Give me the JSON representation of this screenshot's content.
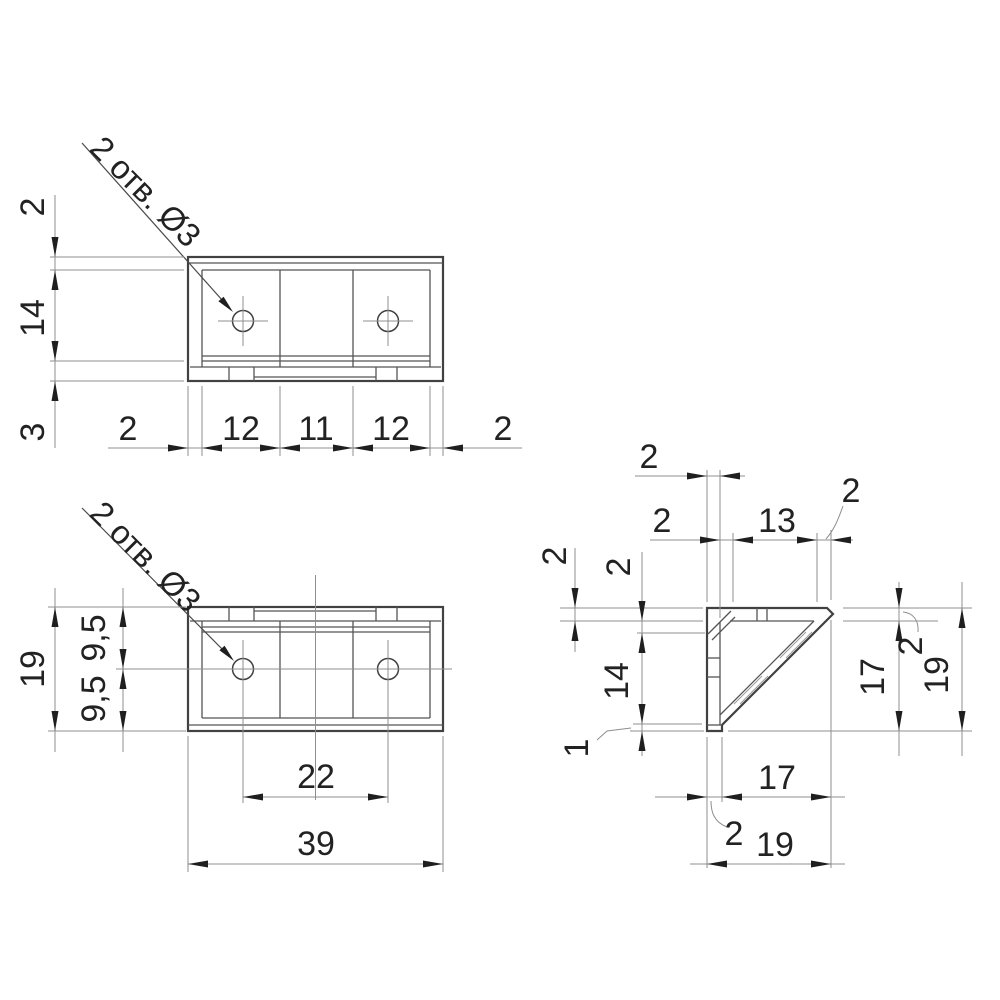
{
  "drawing": {
    "title": "corner-bracket-three-view-drawing",
    "callout_text": "2 отв. Ø3",
    "top_view": {
      "callout": "2 отв. Ø3",
      "left_dims": [
        "2",
        "14",
        "3"
      ],
      "bottom_dims": [
        "2",
        "12",
        "11",
        "12",
        "2"
      ]
    },
    "front_view": {
      "callout": "2 отв. Ø3",
      "left_dims": [
        "19",
        "9,5",
        "9,5"
      ],
      "bottom_dims": [
        "22",
        "39"
      ]
    },
    "side_view": {
      "wall_thickness_dim": "2",
      "top_dims": [
        "2",
        "13",
        "2"
      ],
      "left_dims": [
        "2",
        "2",
        "14",
        "1"
      ],
      "right_dims": [
        "17",
        "2",
        "19"
      ],
      "bottom_dims": [
        "17",
        "2",
        "19"
      ]
    },
    "colors": {
      "background": "#ffffff",
      "edge": "#414141",
      "dimension_lines": "#8f8f8f",
      "text": "#222222"
    }
  }
}
